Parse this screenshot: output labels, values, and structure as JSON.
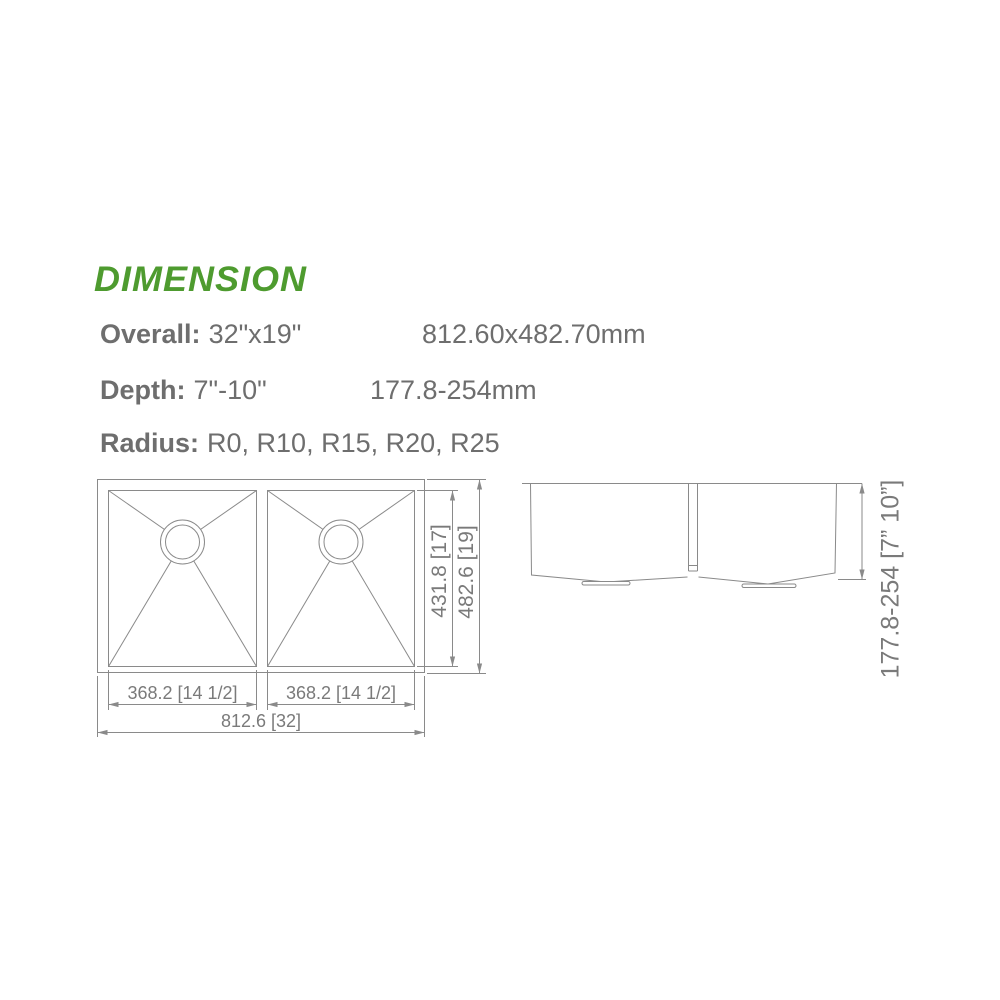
{
  "title": "DIMENSION",
  "colors": {
    "accent_green": "#4E9B2F",
    "text_gray": "#6E6E6E",
    "line_gray": "#8A8A8A"
  },
  "specs": {
    "overall": {
      "label": "Overall:",
      "imperial": "32\"x19\"",
      "metric": "812.60x482.70mm"
    },
    "depth": {
      "label": "Depth:",
      "imperial": "7\"-10\"",
      "metric": "177.8-254mm"
    },
    "radius": {
      "label": "Radius:",
      "values": "R0, R10, R15, R20, R25"
    }
  },
  "drawing": {
    "top_view": {
      "left_bowl_width": "368.2 [14 1/2]",
      "right_bowl_width": "368.2 [14 1/2]",
      "overall_width": "812.6 [32]",
      "bowl_front_to_back": "431.8 [17]",
      "overall_front_to_back": "482.6 [19]"
    },
    "side_view": {
      "depth_range": "177.8-254 [7” 10”]"
    }
  }
}
